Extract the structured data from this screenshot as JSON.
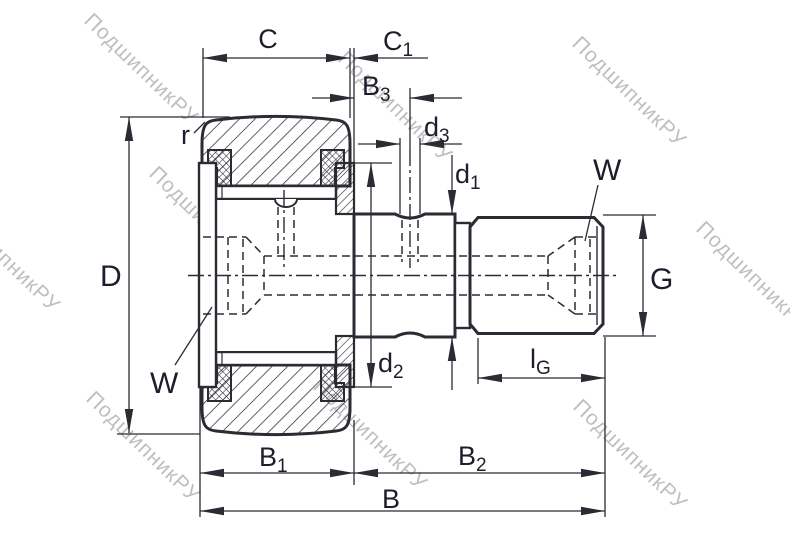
{
  "drawing": {
    "type": "bearing-cross-section",
    "description_labels_present": true
  },
  "watermark": {
    "text": "ПодшипникРУ"
  },
  "colors": {
    "background": "#ffffff",
    "line": "#2b2b33",
    "label": "#1d1d2b",
    "watermark": "#bfbfc2"
  },
  "dimensions": {
    "C": {
      "base": "C",
      "sub": ""
    },
    "C1": {
      "base": "C",
      "sub": "1"
    },
    "B3": {
      "base": "B",
      "sub": "3"
    },
    "d3": {
      "base": "d",
      "sub": "3"
    },
    "d1": {
      "base": "d",
      "sub": "1"
    },
    "d2": {
      "base": "d",
      "sub": "2"
    },
    "D": {
      "base": "D",
      "sub": ""
    },
    "G": {
      "base": "G",
      "sub": ""
    },
    "r": {
      "base": "r",
      "sub": ""
    },
    "W_left": {
      "base": "W",
      "sub": ""
    },
    "W_right": {
      "base": "W",
      "sub": ""
    },
    "lG": {
      "base": "l",
      "sub": "G"
    },
    "B1": {
      "base": "B",
      "sub": "1"
    },
    "B2": {
      "base": "B",
      "sub": "2"
    },
    "B": {
      "base": "B",
      "sub": ""
    }
  }
}
